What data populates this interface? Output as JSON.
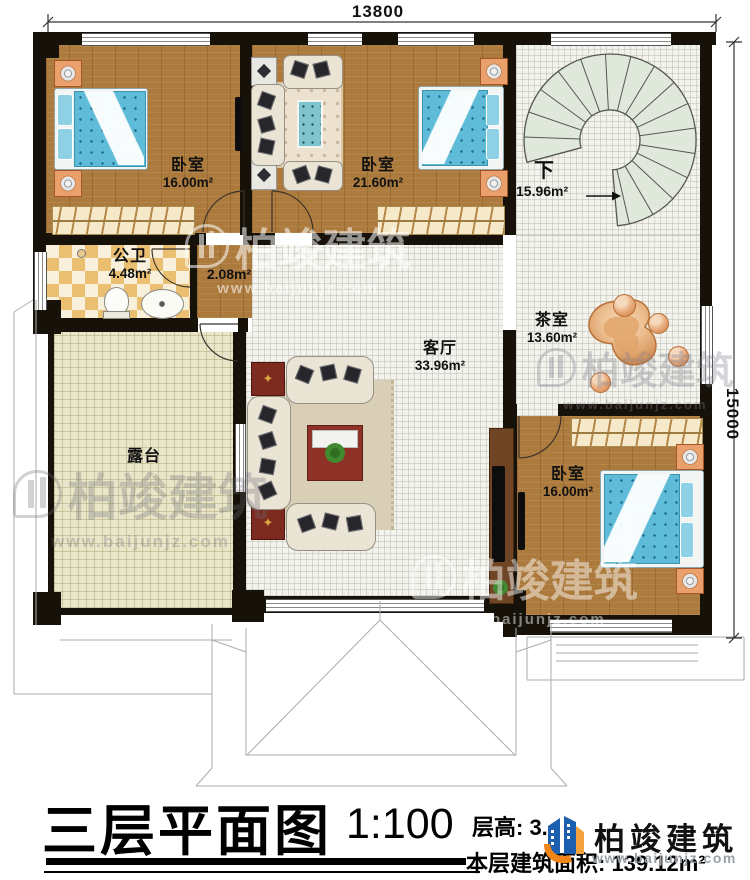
{
  "plan": {
    "dim_width": "13800",
    "dim_height": "15000",
    "rooms": {
      "bedroom1": {
        "name": "卧室",
        "area": "16.00m²"
      },
      "bedroom2": {
        "name": "卧室",
        "area": "21.60m²"
      },
      "bathroom": {
        "name": "公卫",
        "area": "4.48m²"
      },
      "corridor": {
        "area": "2.08m²"
      },
      "living": {
        "name": "客厅",
        "area": "33.96m²"
      },
      "tearoom": {
        "name": "茶室",
        "area": "13.60m²"
      },
      "stairs": {
        "name": "下",
        "area": "15.96m²"
      },
      "terrace": {
        "name": "露台"
      },
      "bedroom3": {
        "name": "卧室",
        "area": "16.00m²"
      }
    }
  },
  "titleblock": {
    "title": "三层平面图",
    "scale": "1:100",
    "floor_height": "层高: 3.",
    "floor_area": "本层建筑面积: 139.12m²"
  },
  "brand": {
    "name": "柏竣建筑",
    "url": "www.baijunjz.com"
  },
  "icons": {
    "side_table_star": "✦"
  },
  "colors": {
    "wall": "#171209",
    "wood_floor": "#ac7a3d",
    "bed_blue": "#5fbcd9",
    "terrace": "#e9e5c9",
    "stair_tread": "#e0e7db",
    "logo_blue": "#1c5fae",
    "logo_orange": "#f08519"
  }
}
